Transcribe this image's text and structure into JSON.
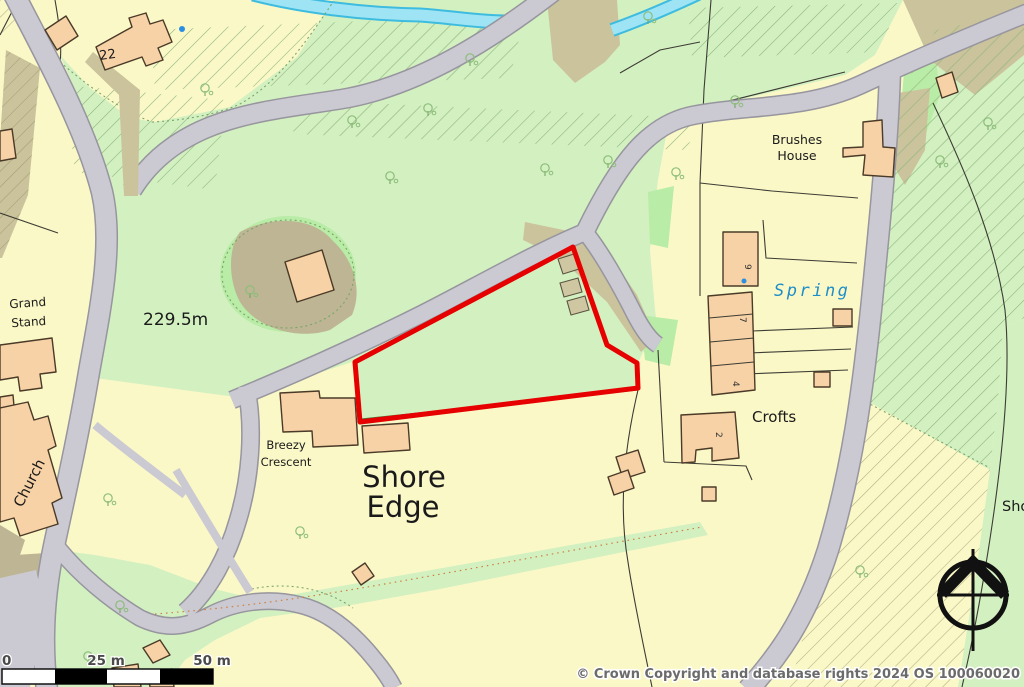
{
  "map_labels": {
    "plot_22": "22",
    "brushes_house": [
      "Brushes",
      "House"
    ],
    "grand_stand": [
      "Grand",
      "Stand"
    ],
    "church": "Church",
    "spot_height": "229.5m",
    "spring": "Spring",
    "crofts": "Crofts",
    "breezy_crescent": [
      "Breezy",
      "Crescent"
    ],
    "shore_edge": [
      "Shore",
      "Edge"
    ],
    "shore_partial": "Sho",
    "house_numbers": {
      "nine": "9",
      "seven": "7",
      "four": "4",
      "two": "2"
    }
  },
  "scale_bar": {
    "labels": [
      "0",
      "25 m",
      "50 m"
    ]
  },
  "attribution": "© Crown Copyright and database rights 2024 OS 100060020",
  "boundary": {
    "points": "355,362 573,247 607,345 637,363 638,388 360,422",
    "color": "#e60000"
  },
  "colors": {
    "field_yellow": "#fbf8c8",
    "grass_green": "#d3f0c1",
    "bright_green": "#b9eca6",
    "woodland_hatch": "#8fb57e",
    "yellow_hatch": "#b3b086",
    "tan": "#cbc39c",
    "tan_dark": "#bdb593",
    "road_fill": "#cbc9d1",
    "road_edge": "#97959d",
    "water_fill": "#9fe4f4",
    "water_edge": "#3ebcdf",
    "building_fill": "#f7d2a6",
    "building_outline": "#4a3a28",
    "outbuilding_fill": "#cfc6a2",
    "line_dark": "#3c3c34",
    "line_green": "#7aa56a",
    "label_black": "#1a1a1a",
    "spring_blue": "#1f8ec8",
    "attribution_gray": "#6b6b6b",
    "scale_text": "#4a4a4a"
  }
}
